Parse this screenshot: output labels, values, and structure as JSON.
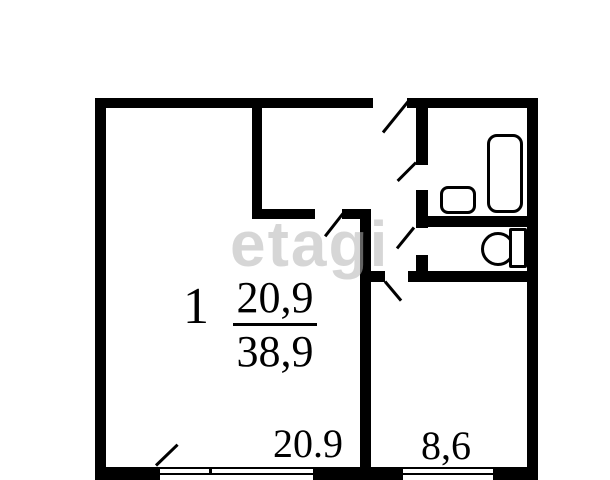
{
  "plan": {
    "unit": {
      "number": "1",
      "living_area": "20,9",
      "total_area": "38,9"
    },
    "labels": {
      "living_room_area": "20.9",
      "kitchen_area": "8,6"
    },
    "watermark": "etagi",
    "fixtures": [
      "bathtub",
      "sink",
      "toilet"
    ],
    "colors": {
      "walls": "#000000",
      "background": "#ffffff",
      "watermark": "#dddddd"
    }
  }
}
